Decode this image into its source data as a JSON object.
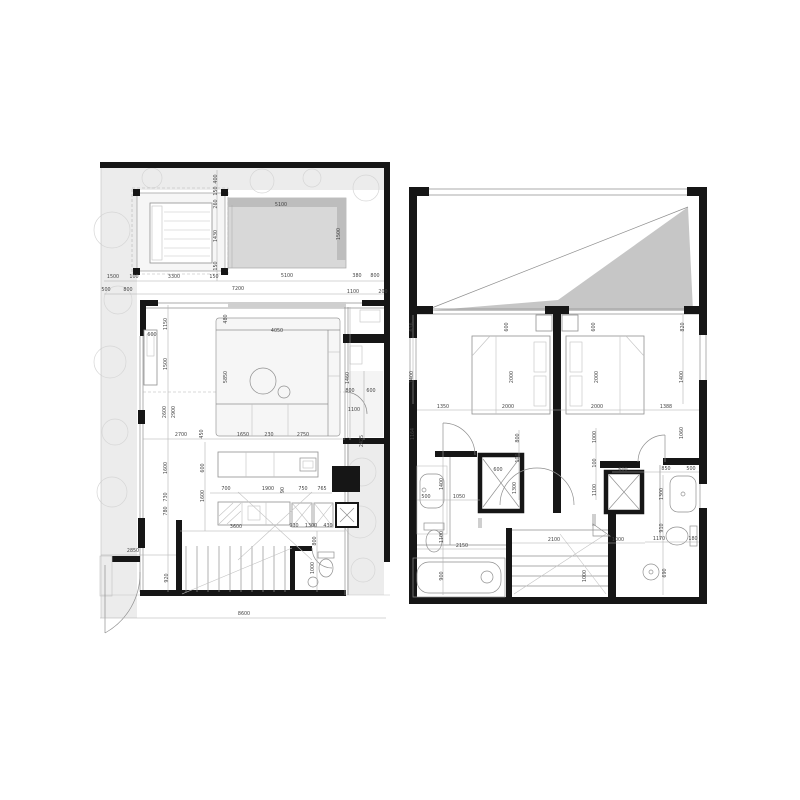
{
  "colors": {
    "bg": "#ffffff",
    "wall": "#161616",
    "dim": "#454545",
    "dimline": "#adadad",
    "veg": "#ececec",
    "pool": "#d8d8d8",
    "poolDark": "#bdbdbd",
    "wedge": "#c6c6c6",
    "sill": "#cfcfcf"
  },
  "dimensions": {
    "left": [
      {
        "x": 217,
        "y": 179,
        "t": "400",
        "r": 1
      },
      {
        "x": 217,
        "y": 191,
        "t": "150",
        "r": 1
      },
      {
        "x": 217,
        "y": 204,
        "t": "260",
        "r": 1
      },
      {
        "x": 217,
        "y": 236,
        "t": "1430",
        "r": 1
      },
      {
        "x": 217,
        "y": 266,
        "t": "150",
        "r": 1
      },
      {
        "x": 281,
        "y": 206,
        "t": "5100"
      },
      {
        "x": 340,
        "y": 234,
        "t": "1500",
        "r": 1
      },
      {
        "x": 113,
        "y": 278,
        "t": "1500"
      },
      {
        "x": 134,
        "y": 278,
        "t": "100"
      },
      {
        "x": 174,
        "y": 278,
        "t": "3300"
      },
      {
        "x": 214,
        "y": 278,
        "t": "150"
      },
      {
        "x": 287,
        "y": 277,
        "t": "5100"
      },
      {
        "x": 357,
        "y": 277,
        "t": "380"
      },
      {
        "x": 375,
        "y": 277,
        "t": "800"
      },
      {
        "x": 106,
        "y": 291,
        "t": "500"
      },
      {
        "x": 128,
        "y": 291,
        "t": "800"
      },
      {
        "x": 238,
        "y": 290,
        "t": "7200"
      },
      {
        "x": 353,
        "y": 293,
        "t": "1100"
      },
      {
        "x": 383,
        "y": 293,
        "t": "200"
      },
      {
        "x": 152,
        "y": 336,
        "t": "600"
      },
      {
        "x": 167,
        "y": 324,
        "t": "1150",
        "r": 1
      },
      {
        "x": 167,
        "y": 364,
        "t": "1500",
        "r": 1
      },
      {
        "x": 227,
        "y": 319,
        "t": "480",
        "r": 1
      },
      {
        "x": 227,
        "y": 377,
        "t": "5850",
        "r": 1
      },
      {
        "x": 277,
        "y": 332,
        "t": "4050"
      },
      {
        "x": 349,
        "y": 378,
        "t": "1460",
        "r": 1
      },
      {
        "x": 181,
        "y": 436,
        "t": "2700"
      },
      {
        "x": 203,
        "y": 434,
        "t": "450",
        "r": 1
      },
      {
        "x": 243,
        "y": 436,
        "t": "1650"
      },
      {
        "x": 269,
        "y": 436,
        "t": "230"
      },
      {
        "x": 303,
        "y": 436,
        "t": "2750"
      },
      {
        "x": 350,
        "y": 392,
        "t": "800"
      },
      {
        "x": 371,
        "y": 392,
        "t": "600"
      },
      {
        "x": 354,
        "y": 411,
        "t": "1100"
      },
      {
        "x": 363,
        "y": 441,
        "t": "2425",
        "r": 1
      },
      {
        "x": 166,
        "y": 412,
        "t": "2600",
        "r": 1
      },
      {
        "x": 175,
        "y": 412,
        "t": "2900",
        "r": 1
      },
      {
        "x": 167,
        "y": 468,
        "t": "1600",
        "r": 1
      },
      {
        "x": 167,
        "y": 497,
        "t": "730",
        "r": 1
      },
      {
        "x": 167,
        "y": 511,
        "t": "780",
        "r": 1
      },
      {
        "x": 133,
        "y": 552,
        "t": "2850"
      },
      {
        "x": 168,
        "y": 578,
        "t": "920",
        "r": 1
      },
      {
        "x": 204,
        "y": 468,
        "t": "600",
        "r": 1
      },
      {
        "x": 204,
        "y": 496,
        "t": "1600",
        "r": 1
      },
      {
        "x": 226,
        "y": 490,
        "t": "700"
      },
      {
        "x": 268,
        "y": 490,
        "t": "1900"
      },
      {
        "x": 284,
        "y": 490,
        "t": "90",
        "r": 1
      },
      {
        "x": 303,
        "y": 490,
        "t": "750"
      },
      {
        "x": 322,
        "y": 490,
        "t": "765"
      },
      {
        "x": 236,
        "y": 528,
        "t": "3600"
      },
      {
        "x": 294,
        "y": 527,
        "t": "930"
      },
      {
        "x": 311,
        "y": 527,
        "t": "1300"
      },
      {
        "x": 328,
        "y": 527,
        "t": "430"
      },
      {
        "x": 316,
        "y": 541,
        "t": "800",
        "r": 1
      },
      {
        "x": 314,
        "y": 568,
        "t": "1000",
        "r": 1
      },
      {
        "x": 244,
        "y": 615,
        "t": "8600"
      }
    ],
    "right": [
      {
        "x": 413,
        "y": 327,
        "t": "616",
        "r": 1
      },
      {
        "x": 413,
        "y": 377,
        "t": "1400",
        "r": 1
      },
      {
        "x": 508,
        "y": 327,
        "t": "600",
        "r": 1
      },
      {
        "x": 513,
        "y": 377,
        "t": "2000",
        "r": 1
      },
      {
        "x": 595,
        "y": 327,
        "t": "600",
        "r": 1
      },
      {
        "x": 598,
        "y": 377,
        "t": "2000",
        "r": 1
      },
      {
        "x": 684,
        "y": 327,
        "t": "820",
        "r": 1
      },
      {
        "x": 683,
        "y": 377,
        "t": "1400",
        "r": 1
      },
      {
        "x": 443,
        "y": 408,
        "t": "1350"
      },
      {
        "x": 508,
        "y": 408,
        "t": "2000"
      },
      {
        "x": 597,
        "y": 408,
        "t": "2000"
      },
      {
        "x": 666,
        "y": 408,
        "t": "1388"
      },
      {
        "x": 414,
        "y": 434,
        "t": "1164",
        "r": 1
      },
      {
        "x": 683,
        "y": 433,
        "t": "1060",
        "r": 1
      },
      {
        "x": 443,
        "y": 484,
        "t": "1400",
        "r": 1
      },
      {
        "x": 426,
        "y": 498,
        "t": "500"
      },
      {
        "x": 459,
        "y": 498,
        "t": "1050"
      },
      {
        "x": 443,
        "y": 537,
        "t": "1100",
        "r": 1
      },
      {
        "x": 462,
        "y": 547,
        "t": "2150"
      },
      {
        "x": 443,
        "y": 576,
        "t": "900",
        "r": 1
      },
      {
        "x": 498,
        "y": 471,
        "t": "600"
      },
      {
        "x": 516,
        "y": 488,
        "t": "1300",
        "r": 1
      },
      {
        "x": 519,
        "y": 438,
        "t": "800",
        "r": 1
      },
      {
        "x": 519,
        "y": 458,
        "t": "100",
        "r": 1
      },
      {
        "x": 596,
        "y": 437,
        "t": "1000",
        "r": 1
      },
      {
        "x": 596,
        "y": 463,
        "t": "100",
        "r": 1
      },
      {
        "x": 596,
        "y": 490,
        "t": "1100",
        "r": 1
      },
      {
        "x": 554,
        "y": 541,
        "t": "2100"
      },
      {
        "x": 618,
        "y": 541,
        "t": "1000"
      },
      {
        "x": 586,
        "y": 576,
        "t": "1000",
        "r": 1
      },
      {
        "x": 623,
        "y": 471,
        "t": "600"
      },
      {
        "x": 666,
        "y": 470,
        "t": "850"
      },
      {
        "x": 691,
        "y": 470,
        "t": "500"
      },
      {
        "x": 663,
        "y": 494,
        "t": "1300",
        "r": 1
      },
      {
        "x": 663,
        "y": 528,
        "t": "910",
        "r": 1
      },
      {
        "x": 659,
        "y": 540,
        "t": "1170"
      },
      {
        "x": 693,
        "y": 540,
        "t": "180"
      },
      {
        "x": 666,
        "y": 573,
        "t": "690",
        "r": 1
      }
    ]
  }
}
